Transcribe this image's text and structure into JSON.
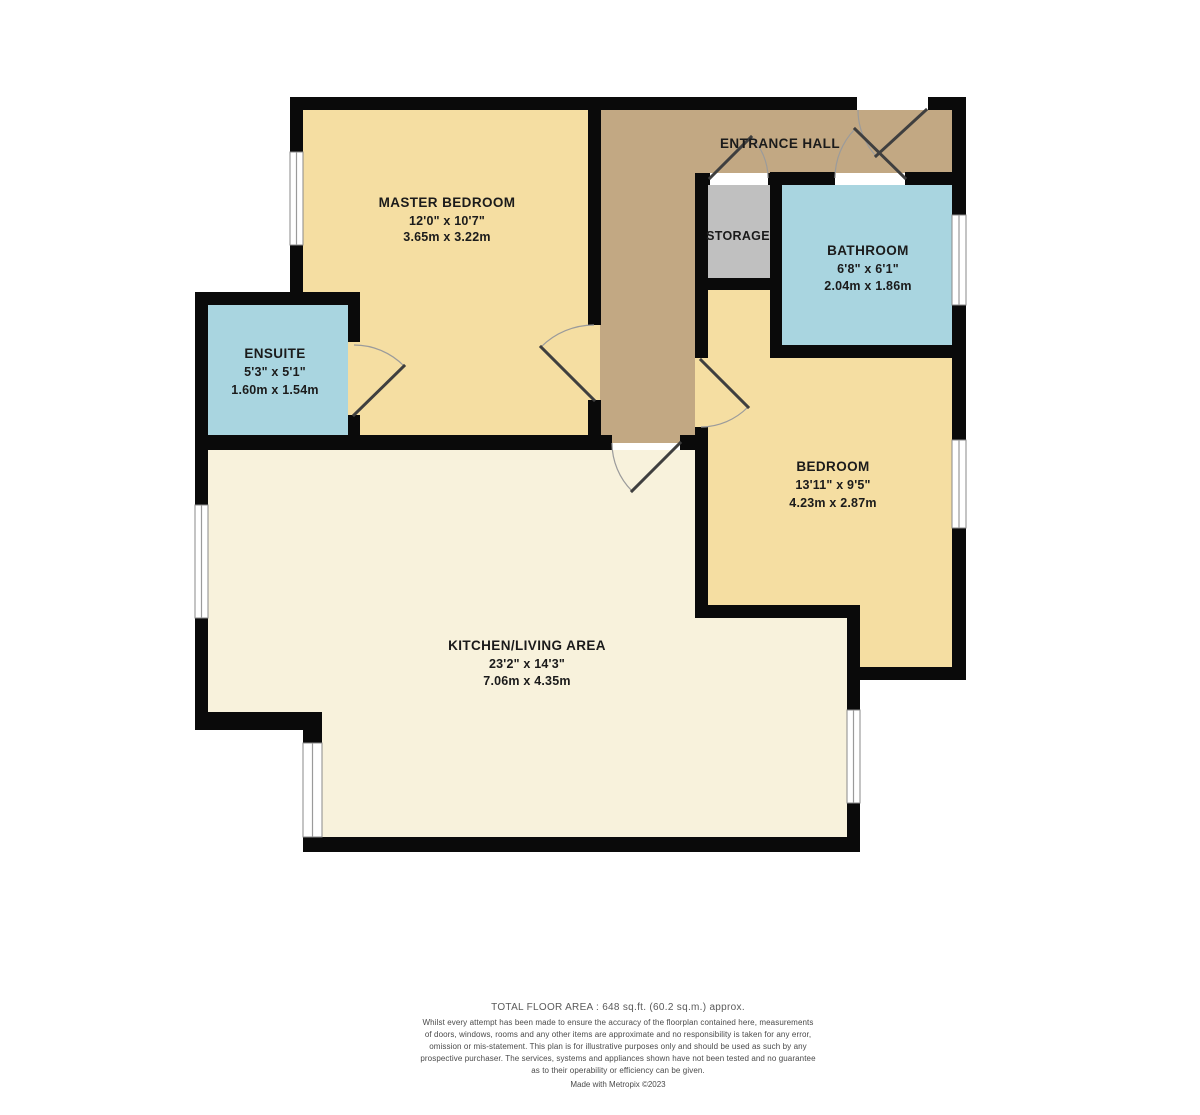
{
  "plan": {
    "rooms": {
      "master_bedroom": {
        "label": "MASTER BEDROOM",
        "imperial": "12'0\" x 10'7\"",
        "metric": "3.65m x 3.22m"
      },
      "entrance_hall": {
        "label": "ENTRANCE HALL"
      },
      "storage": {
        "label": "STORAGE"
      },
      "bathroom": {
        "label": "BATHROOM",
        "imperial": "6'8\" x 6'1\"",
        "metric": "2.04m x 1.86m"
      },
      "ensuite": {
        "label": "ENSUITE",
        "imperial": "5'3\" x 5'1\"",
        "metric": "1.60m x 1.54m"
      },
      "bedroom": {
        "label": "BEDROOM",
        "imperial": "13'11\" x 9'5\"",
        "metric": "4.23m x 2.87m"
      },
      "kitchen_living": {
        "label": "KITCHEN/LIVING AREA",
        "imperial": "23'2\" x 14'3\"",
        "metric": "7.06m x 4.35m"
      }
    },
    "colors": {
      "bedroom_fill": "#F5DEA2",
      "hall_fill": "#C2A883",
      "storage_fill": "#C0C0C0",
      "bath_fill": "#A9D5E0",
      "living_fill": "#F8F2DC",
      "wall": "#0A0A0A"
    }
  },
  "footer": {
    "total_area": "TOTAL FLOOR AREA : 648 sq.ft. (60.2 sq.m.) approx.",
    "disclaimer": "Whilst every attempt has been made to ensure the accuracy of the floorplan contained here, measurements of doors, windows, rooms and any other items are approximate and no responsibility is taken for any error, omission or mis-statement. This plan is for illustrative purposes only and should be used as such by any prospective purchaser. The services, systems and appliances shown have not been tested and no guarantee as to their operability or efficiency can be given.",
    "credit": "Made with Metropix ©2023"
  }
}
